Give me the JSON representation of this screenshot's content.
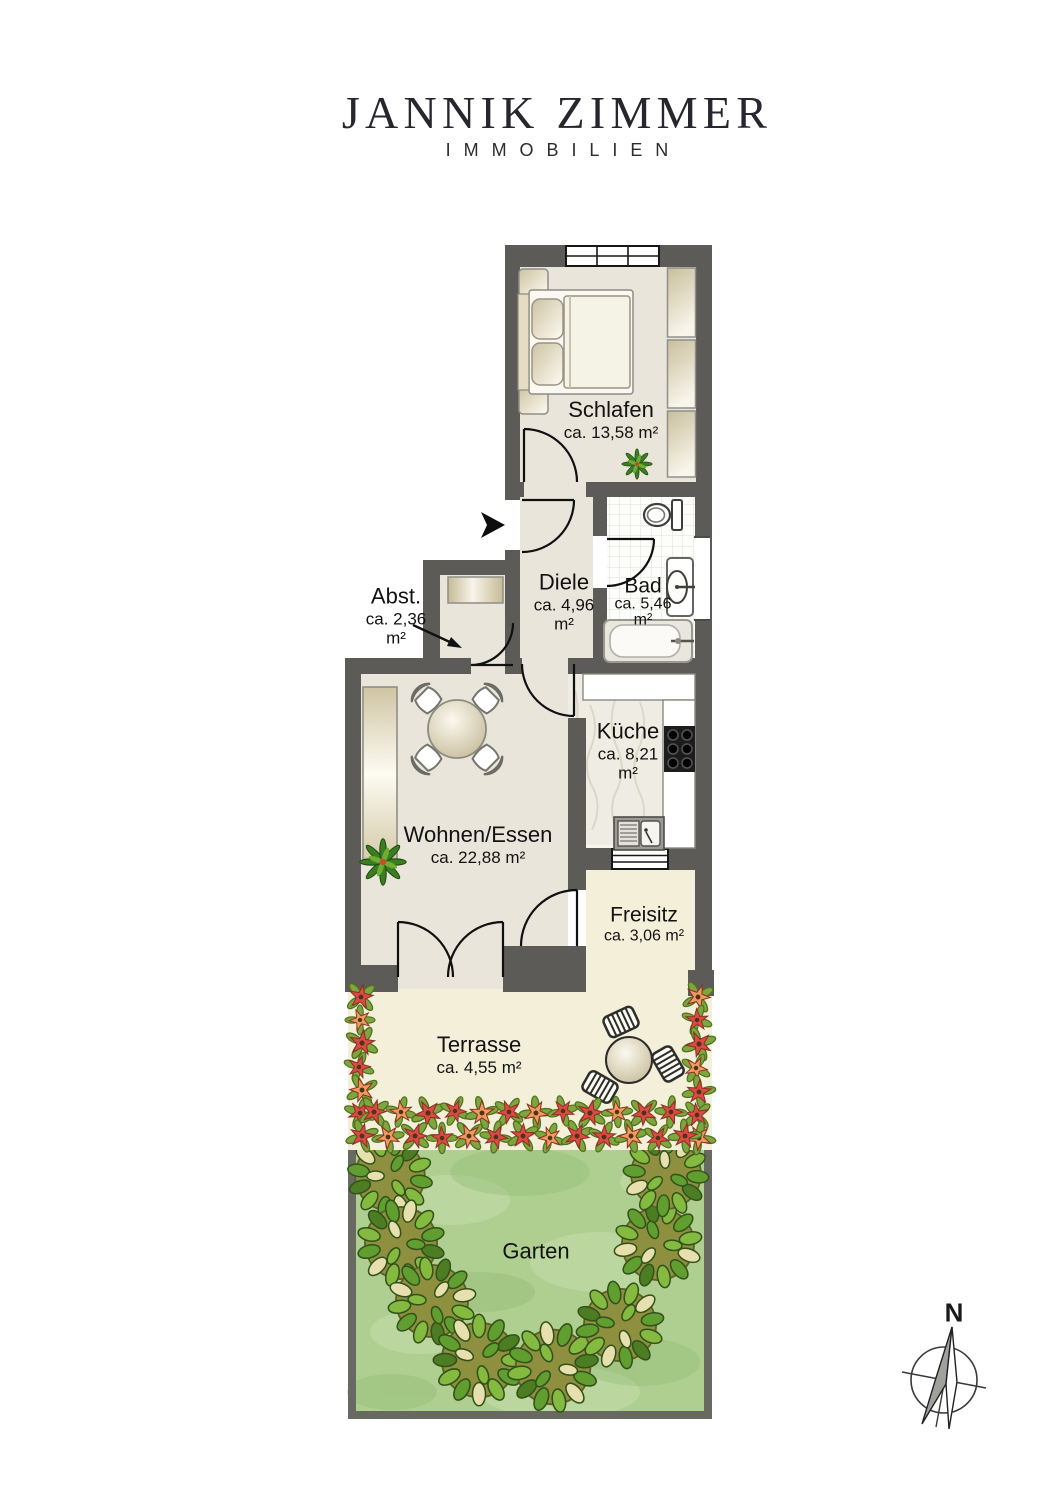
{
  "logo": {
    "title": "JANNIK ZIMMER",
    "subtitle": "IMMOBILIEN"
  },
  "rooms": {
    "schlafen": {
      "name": "Schlafen",
      "area": "ca. 13,58 m²"
    },
    "diele": {
      "name": "Diele",
      "area_line1": "ca. 4,96",
      "area_line2": "m²"
    },
    "bad": {
      "name": "Bad",
      "area_line1": "ca. 5,46",
      "area_line2": "m²"
    },
    "abst": {
      "name": "Abst.",
      "area_line1": "ca. 2,36",
      "area_line2": "m²"
    },
    "kueche": {
      "name": "Küche",
      "area_line1": "ca. 8,21",
      "area_line2": "m²"
    },
    "wohnen": {
      "name": "Wohnen/Essen",
      "area": "ca. 22,88 m²"
    },
    "freisitz": {
      "name": "Freisitz",
      "area": "ca. 3,06 m²"
    },
    "terrasse": {
      "name": "Terrasse",
      "area": "ca. 4,55 m²"
    },
    "garten": {
      "name": "Garten"
    }
  },
  "compass": {
    "north_label": "N"
  },
  "colors": {
    "wall": "#5c5b57",
    "interior_floor": "#e9e5da",
    "outdoor_floor": "#f3efd9",
    "garden_green": "#aecf90",
    "flower_red": "#da4b43",
    "flower_orange": "#eb9c5e"
  }
}
